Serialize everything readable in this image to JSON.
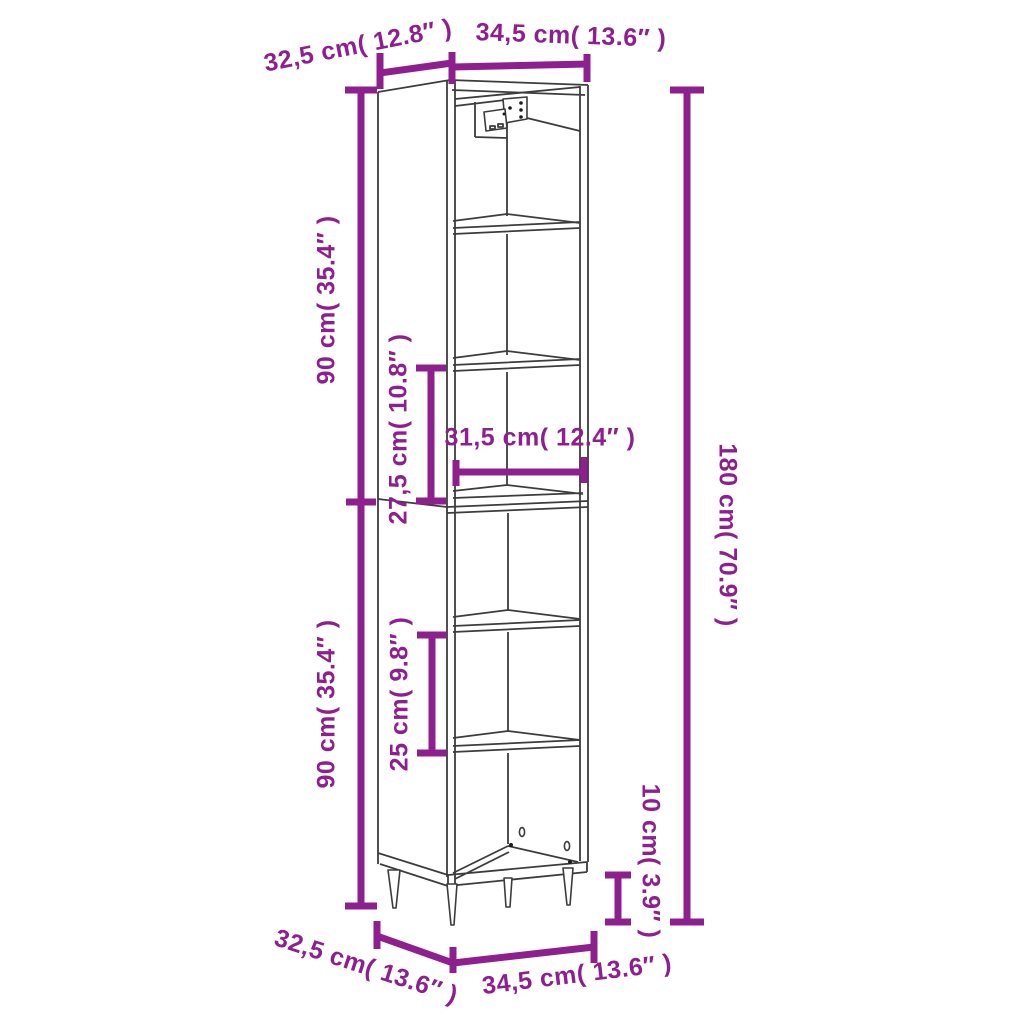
{
  "canvas": {
    "width": 1024,
    "height": 1024,
    "background": "#ffffff"
  },
  "colors": {
    "dimension_accent": "#8e1f8e",
    "drawing_line": "#3c3c3c"
  },
  "figure": {
    "subject": "tall narrow cabinet line drawing with dimension annotations",
    "features": [
      "six open compartments",
      "five shelves",
      "four tapered legs",
      "wall-mount hinge bracket",
      "back panel screw holes"
    ]
  },
  "dimensions": {
    "top_depth": "32,5 cm( 12.8″ )",
    "top_width": "34,5 cm( 13.6″ )",
    "upper_height": "90 cm( 35.4″ )",
    "upper_compartment": "27,5 cm( 10.8″ )",
    "inner_width": "31,5 cm( 12.4″ )",
    "lower_height": "90 cm( 35.4″ )",
    "lower_compartment": "25 cm( 9.8″ )",
    "total_height": "180 cm( 70.9″ )",
    "leg_height": "10 cm( 3.9″ )",
    "bottom_depth": "32,5 cm( 13.6″ )",
    "bottom_width": "34,5 cm( 13.6″ )"
  }
}
